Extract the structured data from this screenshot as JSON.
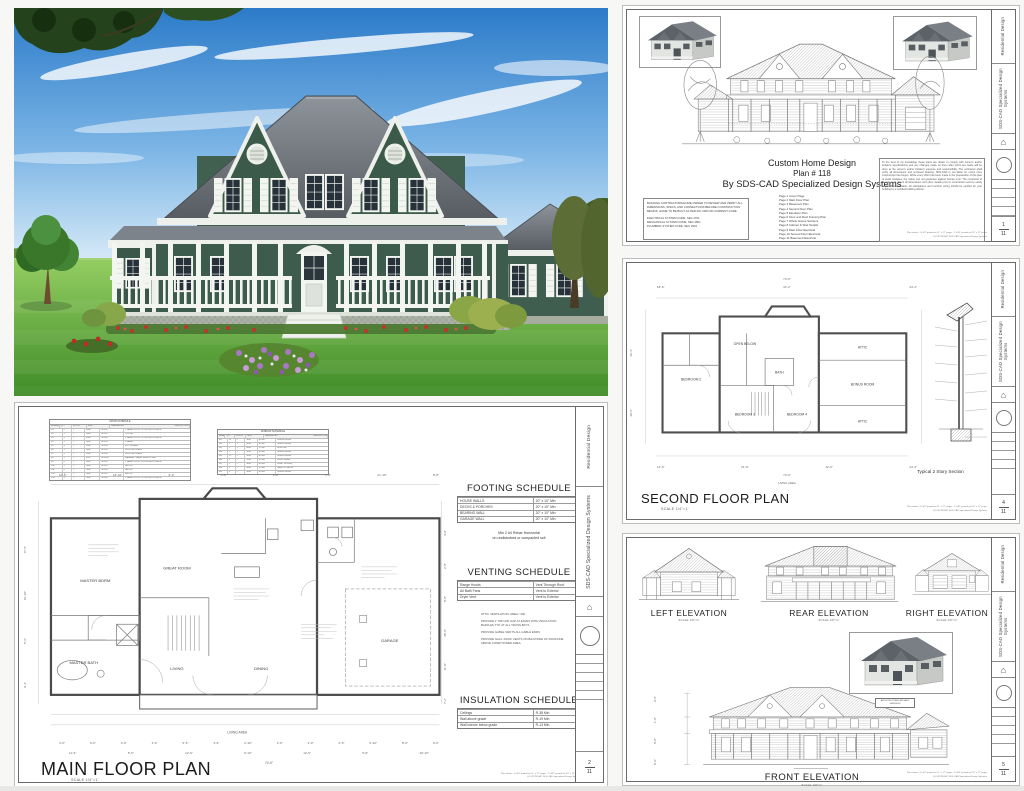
{
  "titleblock": {
    "division": "Residential Design",
    "company_name": "SDS-CAD",
    "company_sub": "Specialized Design Systems",
    "page_total": "11"
  },
  "footer": {
    "print_note": "Plan sheets: 1'=1/4\" printed on 11\" x 17\" paper - 1'=1/8\" printed on 8.5\" x 11\" paper",
    "copyright": "@COPYRIGHT SDS-CAD Specialized Design Systems"
  },
  "cover": {
    "page_no": "1",
    "title_line1": "Custom Home Design",
    "title_line2": "Plan # 118",
    "title_line3": "By SDS-CAD Specialized Design Systems",
    "pages": [
      "Page 1 Cover Page",
      "Page 2 Main Floor Plan",
      "Page 3 Basement Plan",
      "Page 4 Second Floor Plan",
      "Page 5 Elevation Plan",
      "Page 6 Floor and Roof Framing Plan",
      "Page 7 Whole House Sections",
      "Page 8 Cabinet & Stair Details",
      "Page 9 Main Floor Electrical",
      "Page 10 Second Floor Electrical",
      "Page 11 Basement Electrical"
    ],
    "review_note": "BUILDING CONTRACTORS/HOME OWNER TO REVIEW AND VERIFY ALL DIMENSIONS, SPECS, AND CONNECTIONS BEFORE CONSTRUCTION BEGINS. HOME TO BE BUILT AS PER IRC 2003 OR CURRENT CODE",
    "codes": [
      "ELECTRICAL SYSTEM CODE:  SEC 2701",
      "MECHANICAL SYSTEM CODE: SEC 2801",
      "PLUMBING SYSTEM CODE:  SEC 2901"
    ],
    "disclaimer": "To the best of my knowledge these plans are drawn to comply with owner's and/or builder's specifications and any changes made on them after prints are made will be done at the owner's and/or builder's expense and responsibility. The contractor shall verify all dimensions and enclosed drawing. SDS-CAD is not liable for errors once construction has begun. While every effort has been made in the preparation of this plan to avoid mistakes, the maker can not guarantee against human error. The contractor of the job must check all dimensions and other details prior to construction and be solely responsible thereafter. All calculations and member sizing should be verified for your building by a certified building official."
  },
  "second_floor": {
    "page_no": "4",
    "title": "SECOND FLOOR PLAN",
    "scale": "SCALE 1/4\"=1'",
    "section_label": "Typical 2 Story Section",
    "dims_top": [
      "18'-6\"",
      "31'-2\"",
      "24'-4\""
    ],
    "dims_total_top": "74'-0\"",
    "dims_bottom": [
      "12'-6\"",
      "21'-0\"",
      "12'-6\"",
      "24'-4\""
    ],
    "dims_total_bottom": "74'-0\"",
    "dims_left": [
      "26'-4\"",
      "30'-6\""
    ],
    "rooms": {
      "bedroom2": "BEDROOM 2",
      "bedroom3": "BEDROOM 3",
      "bedroom4": "BEDROOM 4",
      "bath": "BATH",
      "bonus": "BONUS ROOM",
      "attic1": "ATTIC",
      "attic2": "ATTIC",
      "open": "OPEN BELOW"
    },
    "living_area_label": "LIVING AREA"
  },
  "elevations": {
    "page_no": "5",
    "left": {
      "label": "LEFT ELEVATION",
      "scale": "SCALE 1/8\"=1'"
    },
    "rear": {
      "label": "REAR ELEVATION",
      "scale": "SCALE 1/8\"=1'"
    },
    "right": {
      "label": "RIGHT ELEVATION",
      "scale": "SCALE 1/8\"=1'"
    },
    "front": {
      "label": "FRONT ELEVATION",
      "scale": "SCALE 1/8\"=1'"
    },
    "roof_note": "ARCHITECTURAL ASPHALT SHINGLES",
    "dims_front_left": [
      "9'-6\"",
      "1'-0\"",
      "8'-0\"",
      "8'-0\""
    ]
  },
  "main_floor": {
    "page_no": "2",
    "title": "MAIN FLOOR PLAN",
    "scale": "SCALE 1/4\"=1'",
    "door_schedule": {
      "title": "DOOR SCHEDULE",
      "headers": [
        "NUMBER",
        "QTY",
        "FLOOR",
        "SIZE",
        "DIMENSIONS",
        "DESCRIPTION"
      ],
      "rows": [
        [
          "D1",
          "2",
          "1",
          "2868",
          "80\"x36\"",
          "2 PANEL DOOR, COLOR BRITE WHITE"
        ],
        [
          "D2",
          "1",
          "1",
          "2868",
          "80\"x32\"",
          "POCKET"
        ],
        [
          "D3",
          "1",
          "1",
          "3068",
          "80\"x36\"",
          "2 PANEL DOOR, COLOR BRITE WHITE"
        ],
        [
          "D4",
          "1",
          "1",
          "2468",
          "80\"x28\"",
          "6 PANEL"
        ],
        [
          "D5",
          "3",
          "1",
          "2668",
          "80\"x30\"",
          "EXT SCREEN"
        ],
        [
          "D6",
          "1",
          "1",
          "2668",
          "80\"x30\"",
          "FROSTED GLASS"
        ],
        [
          "D7",
          "1",
          "1",
          "2668",
          "80\"x30\"",
          "FROSTED GLASS"
        ],
        [
          "D8",
          "1",
          "1",
          "9070",
          "84\"x108\"",
          "GARAGE 2 PANEL SWING OVER"
        ],
        [
          "D9",
          "2",
          "2",
          "2668",
          "80\"x30\"",
          "2 PANEL DOOR, COLOR BRITE WHITE"
        ],
        [
          "D10",
          "1",
          "2",
          "2868",
          "80\"x32\"",
          "BIFOLD"
        ],
        [
          "D11",
          "2",
          "2",
          "2468",
          "80\"x28\"",
          "BIFOLD"
        ],
        [
          "D12",
          "1",
          "2",
          "2868",
          "80\"x32\"",
          "BIFOLD"
        ],
        [
          "D13",
          "1",
          "2",
          "2868",
          "80\"x36\"",
          "2 PANEL DOOR, COLOR BRITE WHITE"
        ]
      ]
    },
    "window_schedule": {
      "title": "WINDOW SCHEDULE",
      "headers": [
        "NUMBER",
        "QTY",
        "FLOOR",
        "SIZE",
        "DIMENSIONS",
        "DESCRIPTION"
      ],
      "rows": [
        [
          "W1",
          "13",
          "1",
          "3050",
          "36\"x60\"",
          "SINGLE HUNG"
        ],
        [
          "W2",
          "2",
          "1",
          "3050",
          "36\"x60\"",
          "SINGLE HUNG"
        ],
        [
          "W3",
          "1",
          "1",
          "6050",
          "72\"x60\"",
          "BOW UNIT"
        ],
        [
          "W4",
          "2",
          "1",
          "3050",
          "36\"x60\"",
          "SINGLE HUNG"
        ],
        [
          "W5",
          "11",
          "2",
          "3040",
          "36\"x48\"",
          "SINGLE HUNG"
        ],
        [
          "W6",
          "1",
          "2",
          "2030",
          "24\"x36\"",
          "FIXED GLASS"
        ],
        [
          "W7",
          "1",
          "2",
          "3040",
          "36\"x48\"",
          "RIGHT SLIDING"
        ],
        [
          "W8",
          "2",
          "2",
          "6040",
          "72\"x48\"",
          "SASH OCTAGON"
        ],
        [
          "W9",
          "4",
          "2",
          "3040",
          "36\"x48\"",
          "SINGLE HUNG"
        ]
      ]
    },
    "footing_schedule": {
      "title": "FOOTING SCHEDULE",
      "rows": [
        [
          "HOUSE WALLS",
          "20\" x 10\" Min"
        ],
        [
          "DECKS & PORCHES",
          "20\" x 10\" Min"
        ],
        [
          "BEARING WALL",
          "20\" x 10\" Min"
        ],
        [
          "GARAGE WALL",
          "20\" x 10\" Min"
        ]
      ],
      "note1": "Min 2 #4 Rebar Horizontal",
      "note2": "on undisturbed or compacted soil"
    },
    "venting_schedule": {
      "title": "VENTING SCHEDULE",
      "rows": [
        [
          "Range Hoods",
          "Vent Through Roof"
        ],
        [
          "All Bath Fans",
          "Vent to Exterior"
        ],
        [
          "Dryer Vent",
          "Vent to Exterior"
        ]
      ]
    },
    "attic_notes": [
      "ATTIC VENTILATION: AREA / 300",
      "PROVIDE 1\" MIN AIR GAP AT EAVES WITH INSULATION BAFFLES TYP. AT ALL TRUSS BAYS",
      "PROVIDE GABLE VENTS ALL GABLE ENDS",
      "PROVIDE GALV. ROOF VENTS ON BACKSIDE OF ROOFLINE ABOVE CONDITIONED AREA."
    ],
    "insulation_schedule": {
      "title": "INSULATION SCHEDULE",
      "rows": [
        [
          "Ceilings",
          "R-38 Min"
        ],
        [
          "Wall above grade",
          "R-19 Min"
        ],
        [
          "Wall interior below grade",
          "R-13 Min"
        ]
      ]
    },
    "rooms": {
      "master": "MASTER BDRM",
      "great": "GREAT ROOM",
      "master_bath": "MASTER BATH",
      "living": "LIVING",
      "dining": "DINING",
      "garage": "GARAGE"
    },
    "living_area_label": "LIVING AREA",
    "dims_top": [
      "10'-6\"",
      "18'-10\"",
      "9'-0\"",
      "5'-8\"",
      "2'-8\"",
      "1'-0\"",
      "21'-10\"",
      "8'-8\""
    ],
    "dims_bottom_1": [
      "4'-6\"",
      "6'-6\"",
      "3'-0\"",
      "3'-6\"",
      "5'-6\"",
      "3'-6\"",
      "2'-10\"",
      "3'-6\"",
      "3'-0\"",
      "2'-6\"",
      "6'-10\"",
      "8'-6\"",
      "9'-6\""
    ],
    "dims_bottom_2": [
      "11'-6\"",
      "5'-6\"",
      "12'-6\"",
      "5'-10\"",
      "12'-6\"",
      "5'-6\"",
      "20'-10\""
    ],
    "dims_total": "74'-6\"",
    "dims_left": [
      "17'-0\"",
      "15'-10\"",
      "5'-6\"",
      "9'-4\""
    ],
    "dims_right": [
      "4'-0\"",
      "2'-8\"",
      "8'-8\"",
      "28'-0\"",
      "11'-8\"",
      "7'-2\""
    ]
  }
}
